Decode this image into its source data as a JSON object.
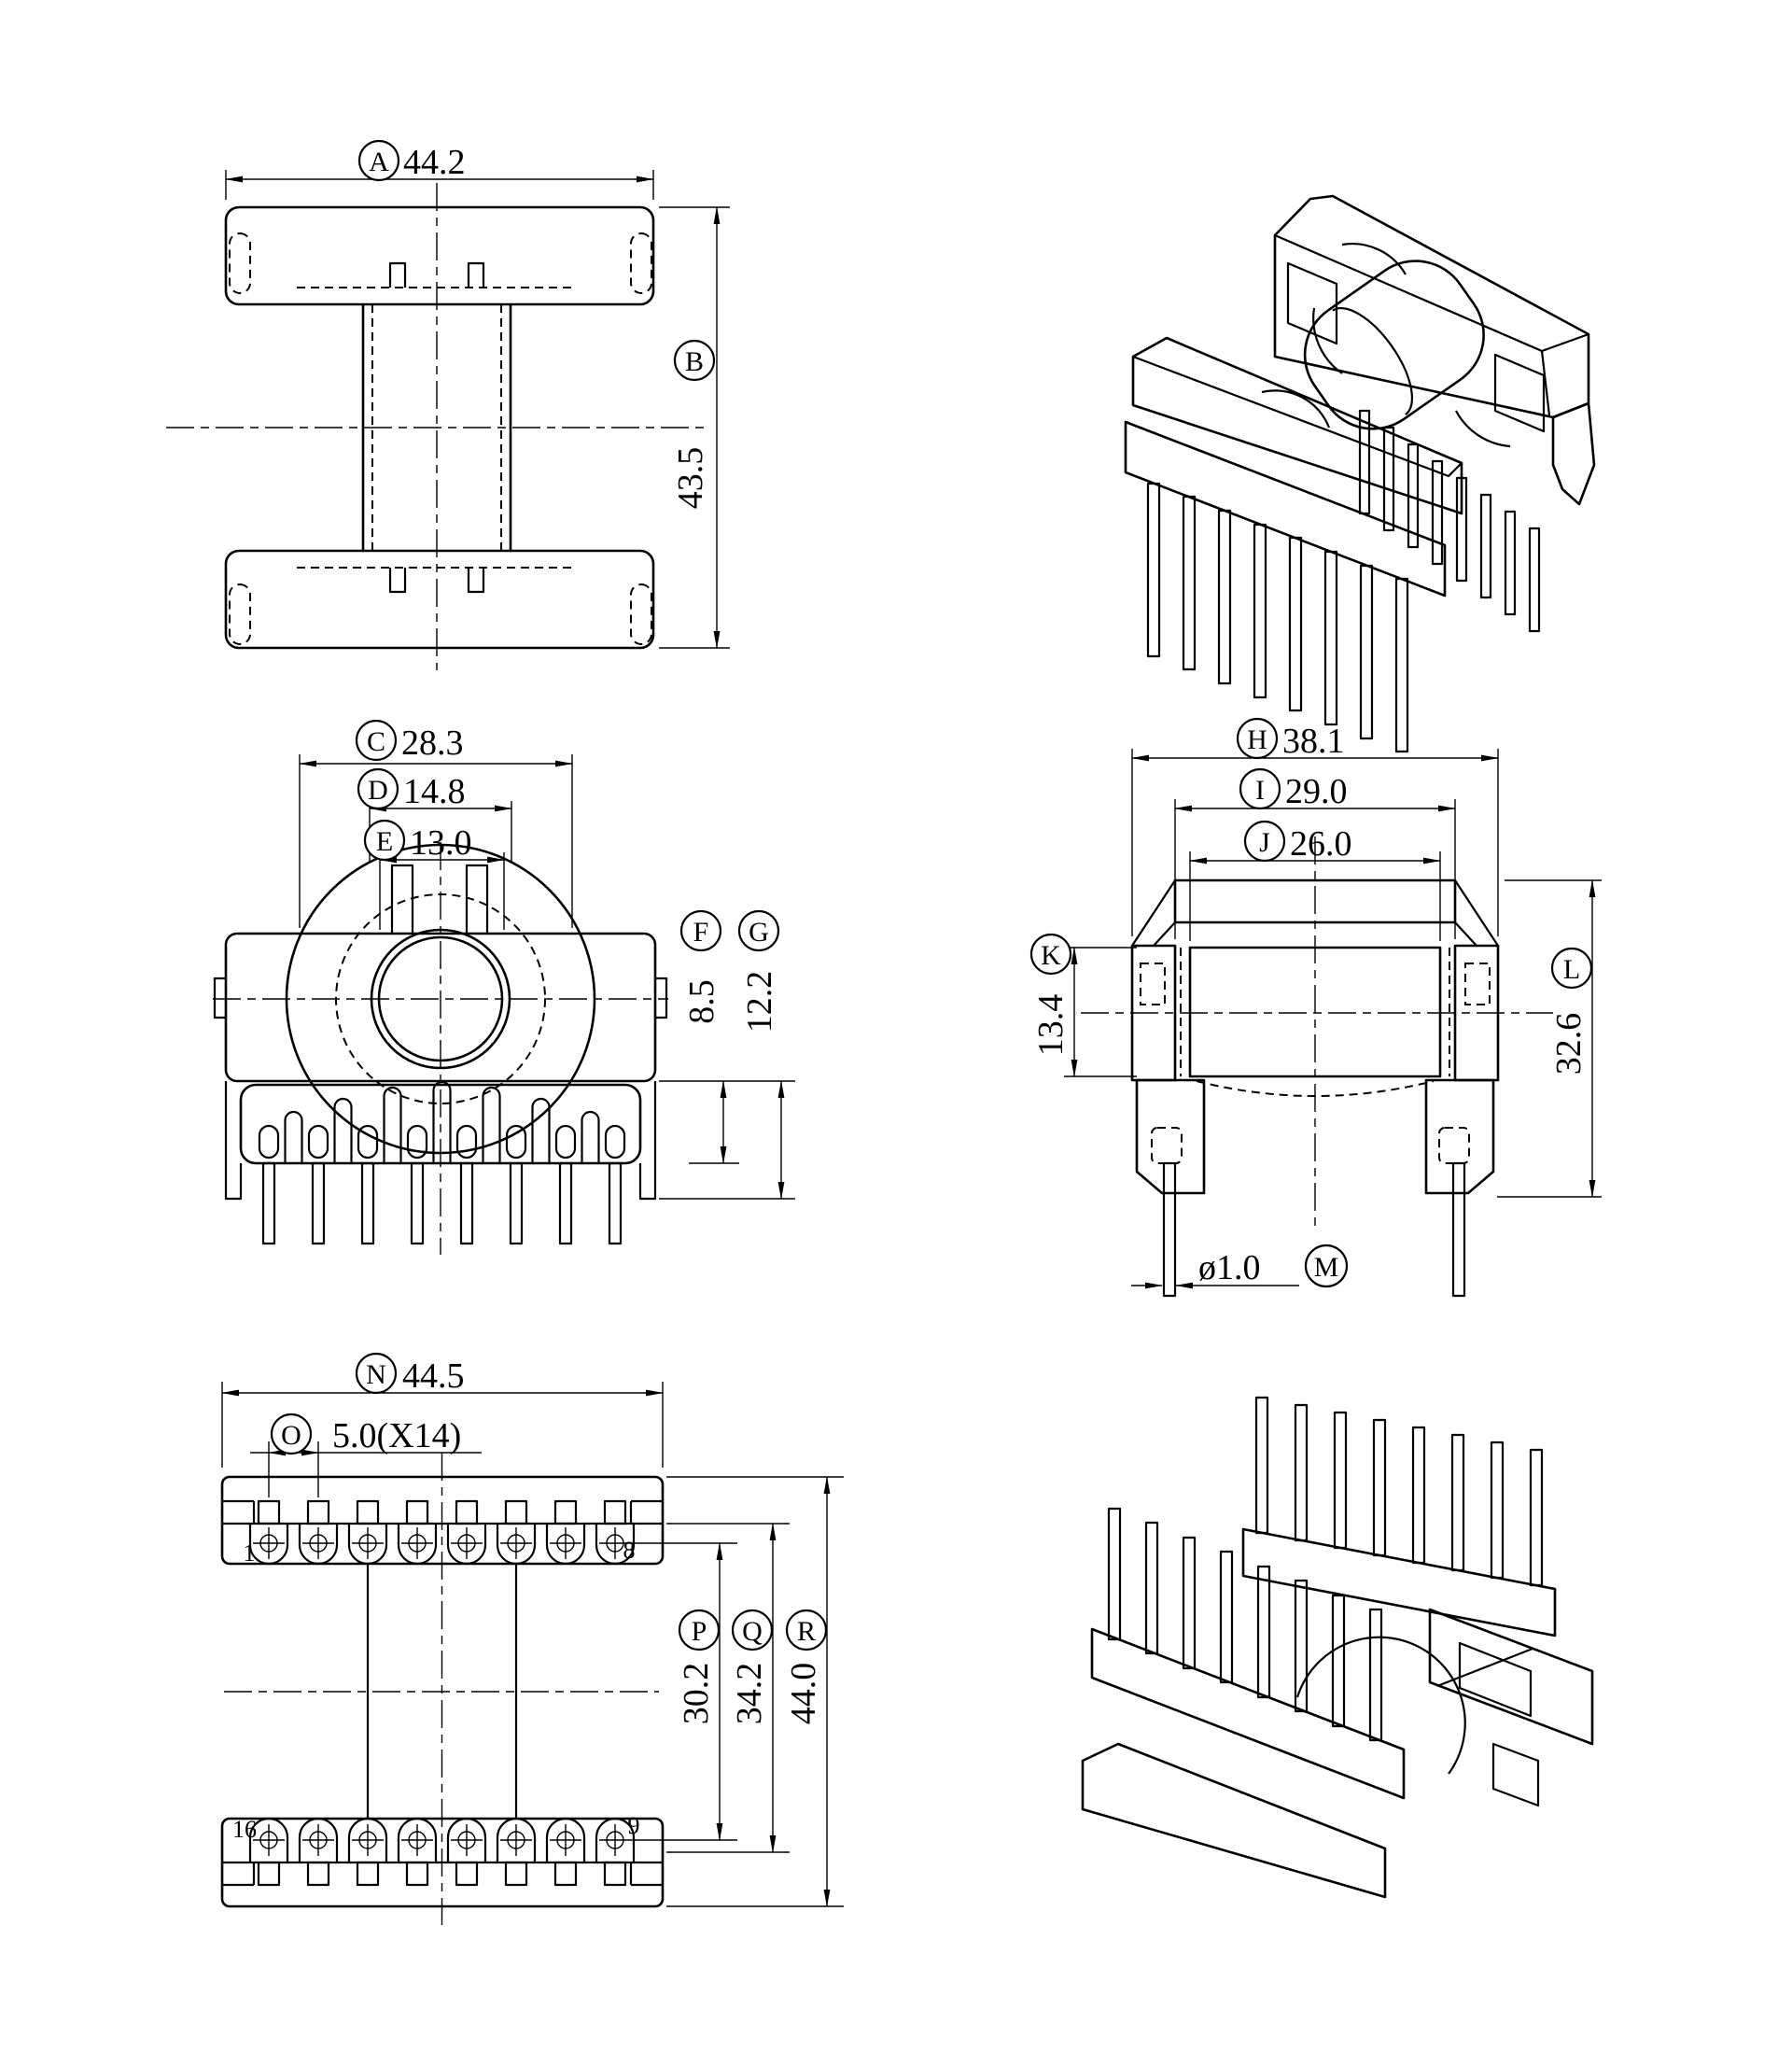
{
  "colors": {
    "line": "#000000",
    "background": "#ffffff"
  },
  "dims": {
    "A": {
      "letter": "A",
      "value": "44.2"
    },
    "B": {
      "letter": "B",
      "value": "43.5"
    },
    "C": {
      "letter": "C",
      "value": "28.3"
    },
    "D": {
      "letter": "D",
      "value": "14.8"
    },
    "E": {
      "letter": "E",
      "value": "13.0"
    },
    "F": {
      "letter": "F",
      "value": "8.5"
    },
    "G": {
      "letter": "G",
      "value": "12.2"
    },
    "H": {
      "letter": "H",
      "value": "38.1"
    },
    "I": {
      "letter": "I",
      "value": "29.0"
    },
    "J": {
      "letter": "J",
      "value": "26.0"
    },
    "K": {
      "letter": "K",
      "value": "13.4"
    },
    "L": {
      "letter": "L",
      "value": "32.6"
    },
    "M": {
      "letter": "M",
      "value": "ø1.0"
    },
    "N": {
      "letter": "N",
      "value": "44.5"
    },
    "O": {
      "letter": "O",
      "value": "5.0(X14)"
    },
    "P": {
      "letter": "P",
      "value": "30.2"
    },
    "Q": {
      "letter": "Q",
      "value": "34.2"
    },
    "R": {
      "letter": "R",
      "value": "44.0"
    }
  },
  "pins": {
    "row1_first": "1",
    "row1_last": "8",
    "row2_first": "16",
    "row2_last": "9"
  }
}
